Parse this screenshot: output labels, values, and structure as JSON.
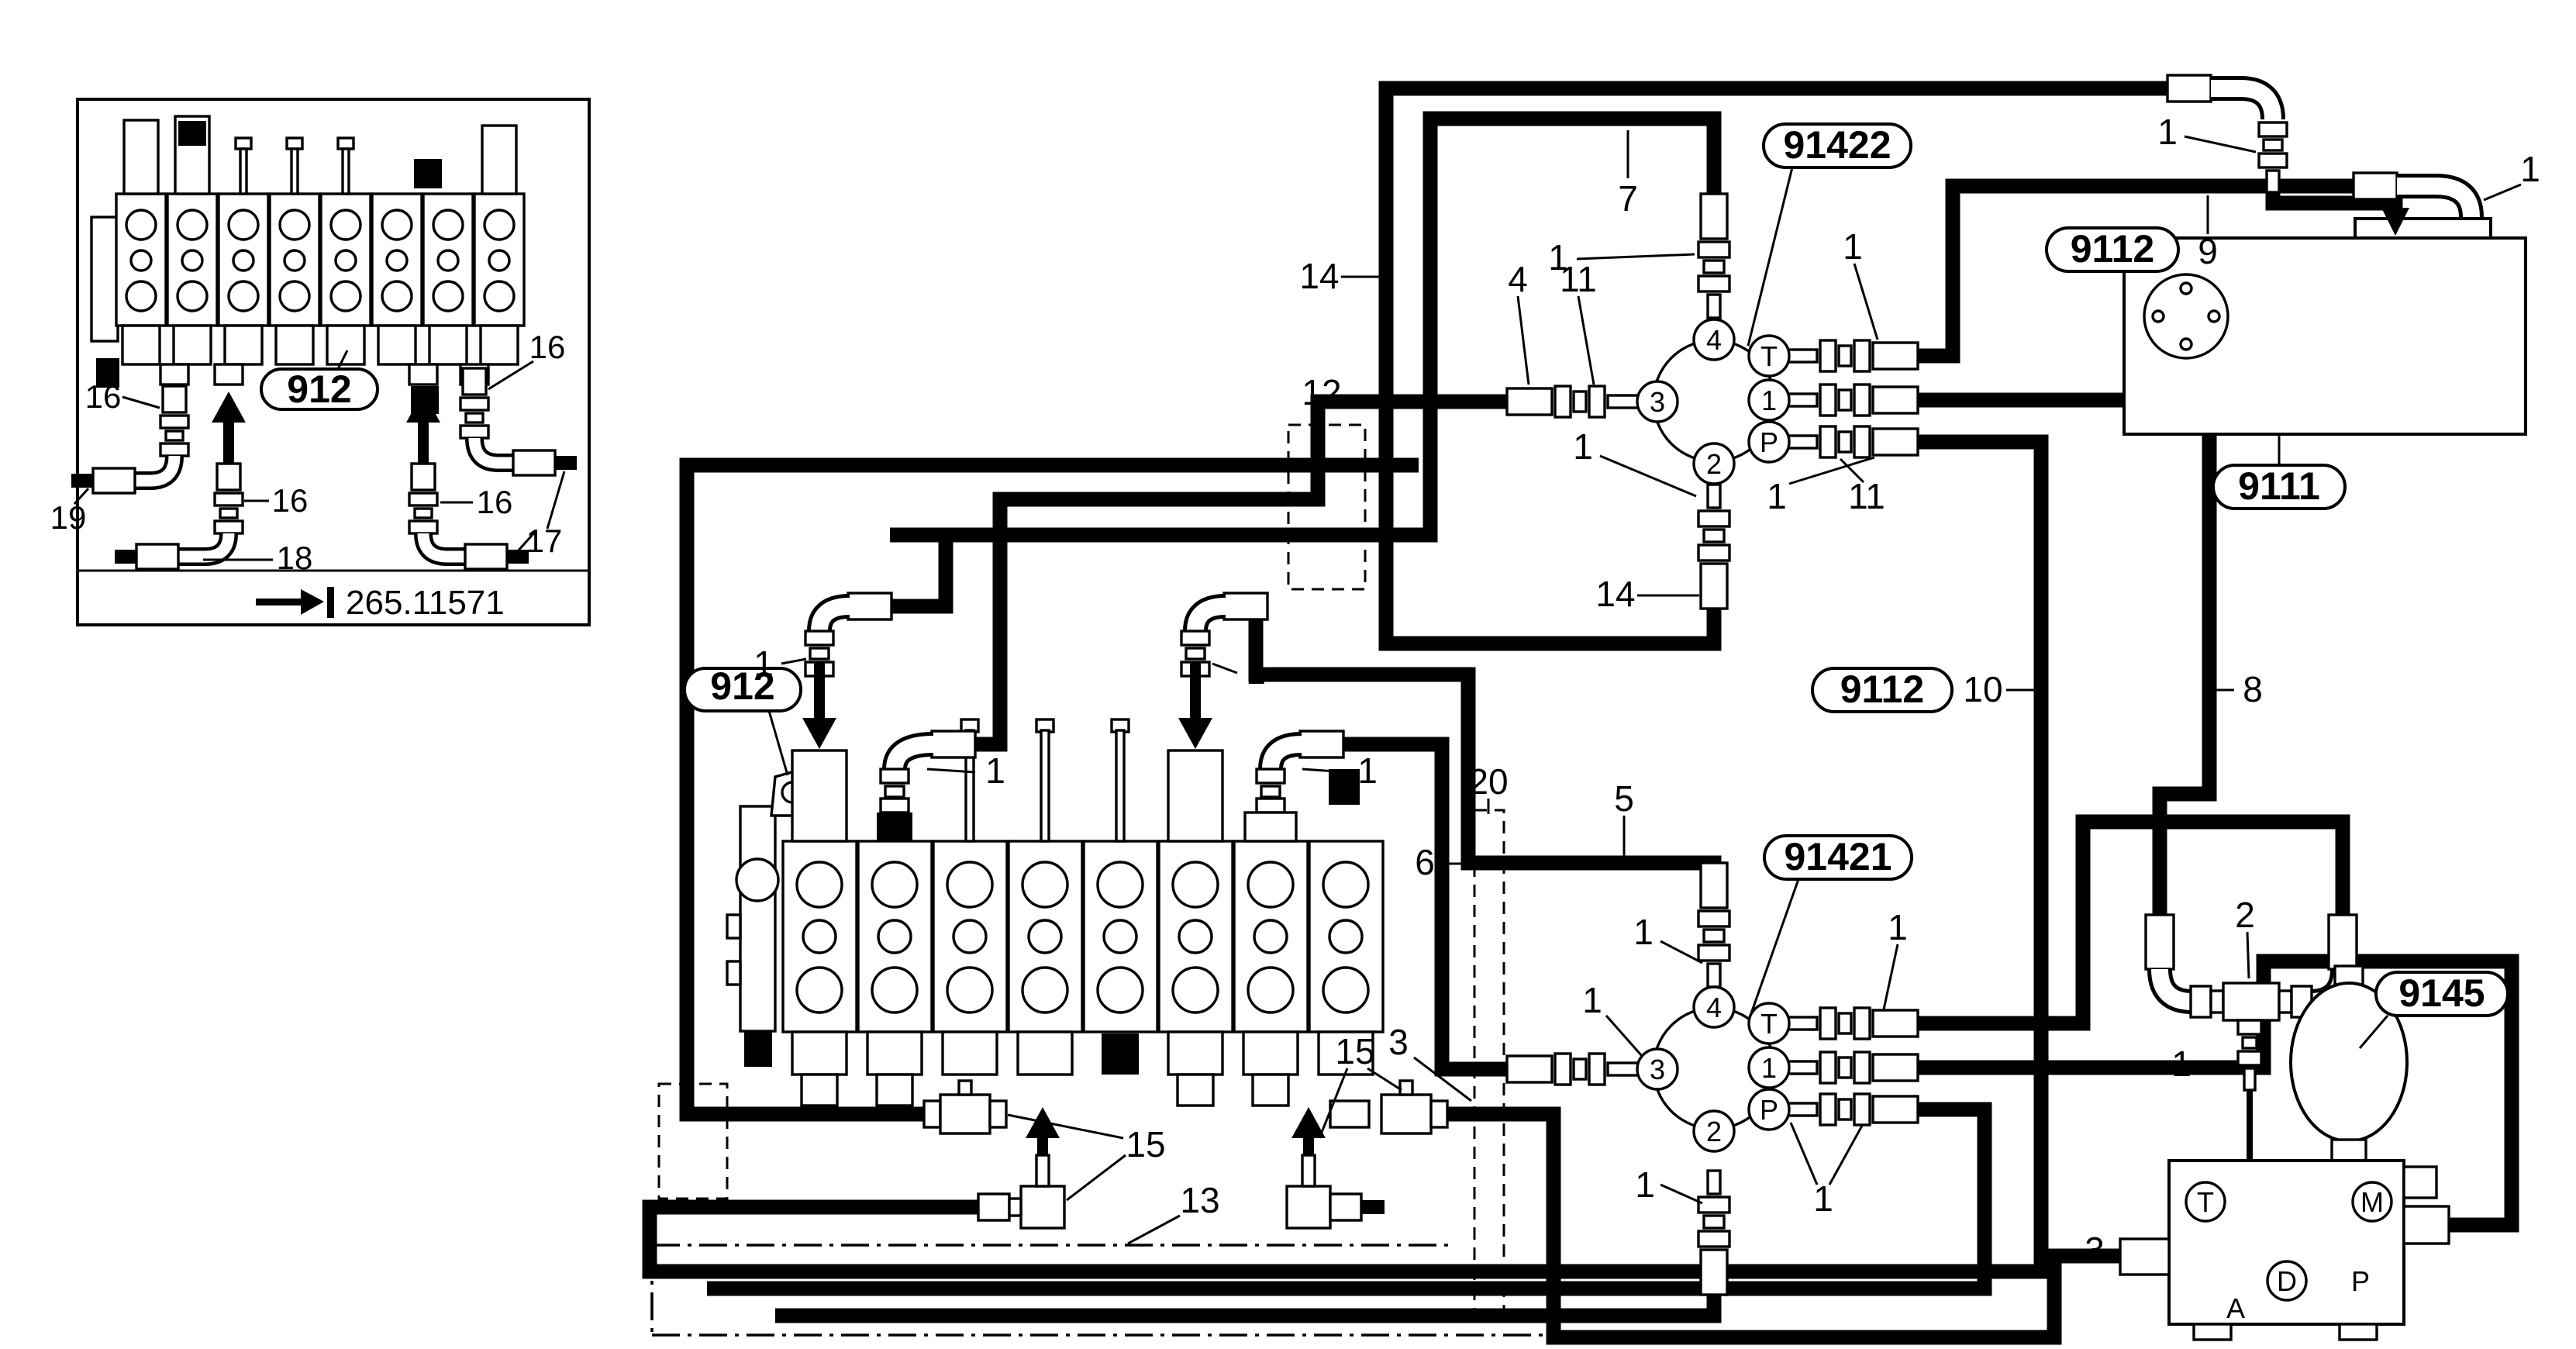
{
  "labels": {
    "valve_group": "912",
    "junction_top": "91422",
    "junction_bottom": "91421",
    "tank": "9111",
    "hose_kit": "9112",
    "pump": "9145"
  },
  "callouts": {
    "c1": "1",
    "c2": "2",
    "c3": "3",
    "c4": "4",
    "c5": "5",
    "c6": "6",
    "c7": "7",
    "c8": "8",
    "c9": "9",
    "c10": "10",
    "c11": "11",
    "c12": "12",
    "c13": "13",
    "c14": "14",
    "c15": "15",
    "c16": "16",
    "c17": "17",
    "c18": "18",
    "c19": "19",
    "c20": "20"
  },
  "ports": {
    "p1": "1",
    "p2": "2",
    "p3": "3",
    "p4": "4",
    "t": "T",
    "p": "P",
    "m": "M",
    "d": "D",
    "a": "A"
  },
  "reference": {
    "number": "265.11571"
  }
}
